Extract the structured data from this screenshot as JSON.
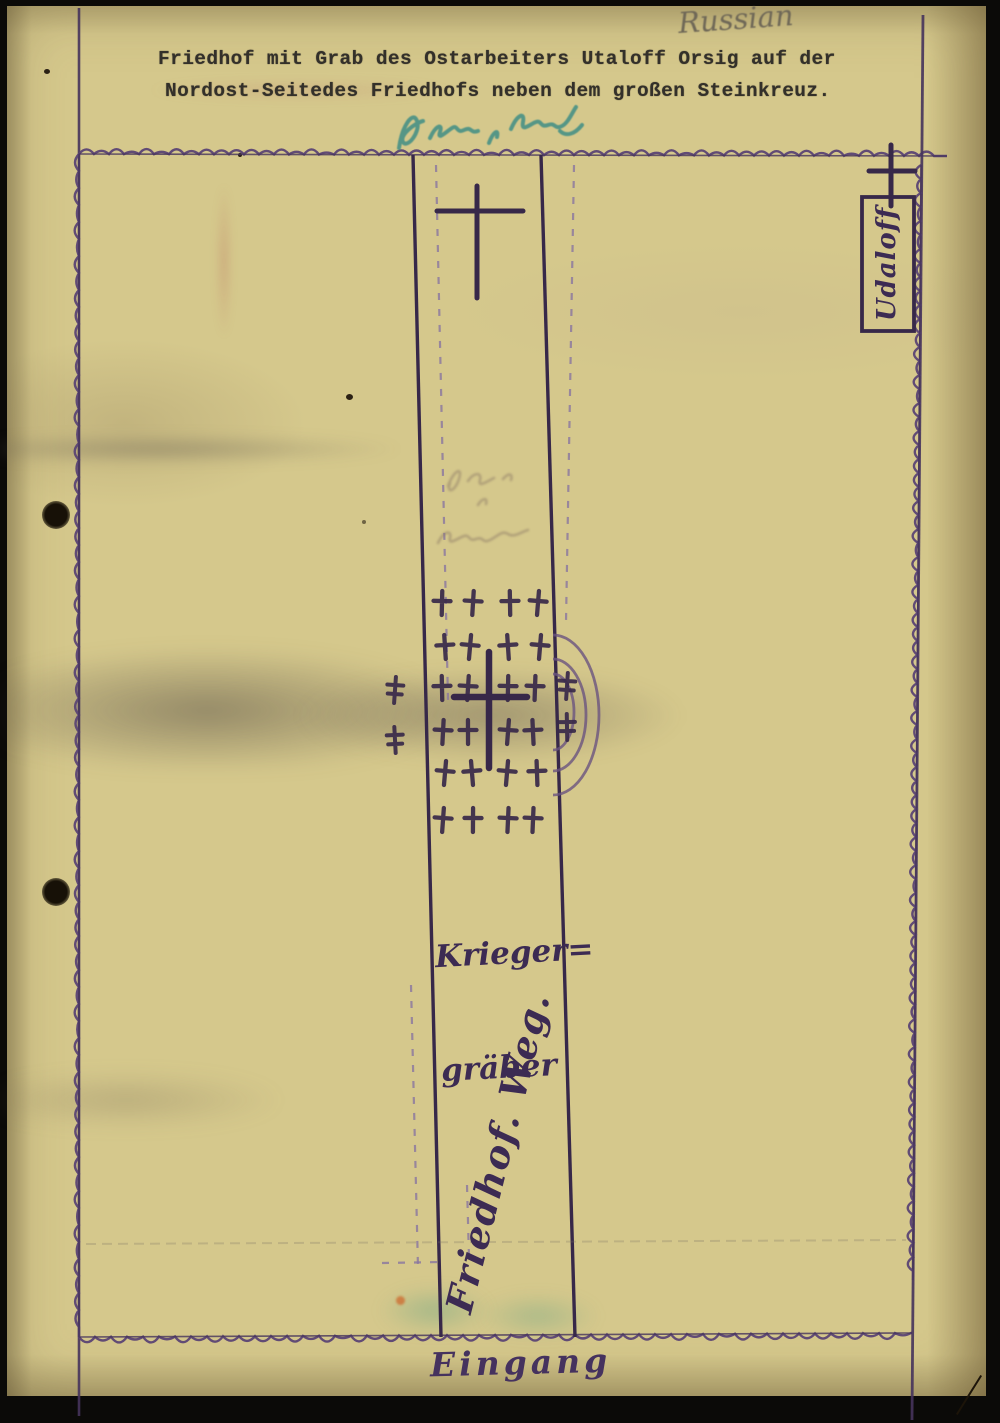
{
  "document": {
    "classification_note": "Russian",
    "title_line1": "Friedhof mit Grab des Ostarbeiters Utaloff Orsig auf der",
    "title_line2": "Nordost-Seitedes Friedhofs neben dem großen Steinkreuz.",
    "teal_annotation_transcript": "illegible teal handwriting",
    "path_pencil_note_transcript": "illegible faded pencil note"
  },
  "map": {
    "labels": {
      "grave_box": "Udaloff",
      "war_graves_line1": "Krieger=",
      "war_graves_line2": "gräber",
      "path_label": "Friedhof. Weg.",
      "entrance_label": "Eingang"
    },
    "colors": {
      "ink": "#46345c",
      "ink_dark": "#372849",
      "fence": "#5b4574",
      "dashed": "#8a76a0",
      "teal": "#3f8e85",
      "pencil": "#8d7a66",
      "paper": "#d5c88c",
      "typed": "#33302a"
    },
    "geometry": {
      "margin_line": {
        "x": 79,
        "y1": 8,
        "y2": 1416
      },
      "boundary": {
        "top": [
          79,
          154,
          947,
          156
        ],
        "bottom": [
          79,
          1337,
          912,
          1333
        ],
        "left": [
          79,
          154,
          79,
          1337
        ],
        "right_line": [
          923,
          15,
          912,
          1420
        ],
        "right_scallops": [
          921,
          165,
          913,
          1280
        ]
      },
      "path_lines": {
        "left": [
          413,
          155,
          441,
          1337
        ],
        "right": [
          541,
          155,
          575,
          1337
        ]
      },
      "dashed_lines": [
        [
          436,
          165,
          448,
          700
        ],
        [
          574,
          165,
          566,
          622
        ],
        [
          411,
          985,
          418,
          1268
        ],
        [
          467,
          1185,
          469,
          1258
        ],
        [
          382,
          1263,
          442,
          1262
        ]
      ],
      "pencil_line": [
        86,
        1244,
        906,
        1240
      ],
      "stone_cross": {
        "v": [
          477,
          186,
          477,
          298
        ],
        "h": [
          437,
          211,
          523,
          211
        ],
        "w": 5
      },
      "udaloff_cross": {
        "v": [
          891,
          145,
          891,
          206
        ],
        "h": [
          869,
          171,
          915,
          171
        ],
        "w": 5
      },
      "udaloff_box": {
        "x": 862,
        "y": 197,
        "w": 52,
        "h": 134
      },
      "large_grave_cross": {
        "v": [
          489,
          652,
          489,
          768
        ],
        "h": [
          454,
          697,
          527,
          697
        ],
        "w": 6.5
      },
      "grave_crosses": [
        [
          442,
          603
        ],
        [
          473,
          603
        ],
        [
          510,
          603
        ],
        [
          538,
          603
        ],
        [
          445,
          647
        ],
        [
          470,
          647
        ],
        [
          508,
          647
        ],
        [
          540,
          647
        ],
        [
          442,
          688
        ],
        [
          468,
          688
        ],
        [
          508,
          688
        ],
        [
          535,
          688
        ],
        [
          443,
          732
        ],
        [
          468,
          732
        ],
        [
          508,
          732
        ],
        [
          533,
          732
        ],
        [
          445,
          773
        ],
        [
          472,
          773
        ],
        [
          507,
          773
        ],
        [
          537,
          773
        ],
        [
          443,
          820
        ],
        [
          473,
          820
        ],
        [
          508,
          820
        ],
        [
          533,
          820
        ]
      ],
      "outside_crosses": [
        [
          395,
          690
        ],
        [
          395,
          740
        ],
        [
          567,
          686
        ],
        [
          567,
          727
        ]
      ],
      "arcs": [
        {
          "cx": 553,
          "cy": 715,
          "rx": 46,
          "ry": 80
        },
        {
          "cx": 553,
          "cy": 715,
          "rx": 33,
          "ry": 56
        },
        {
          "cx": 553,
          "cy": 712,
          "rx": 21,
          "ry": 38
        }
      ]
    }
  }
}
